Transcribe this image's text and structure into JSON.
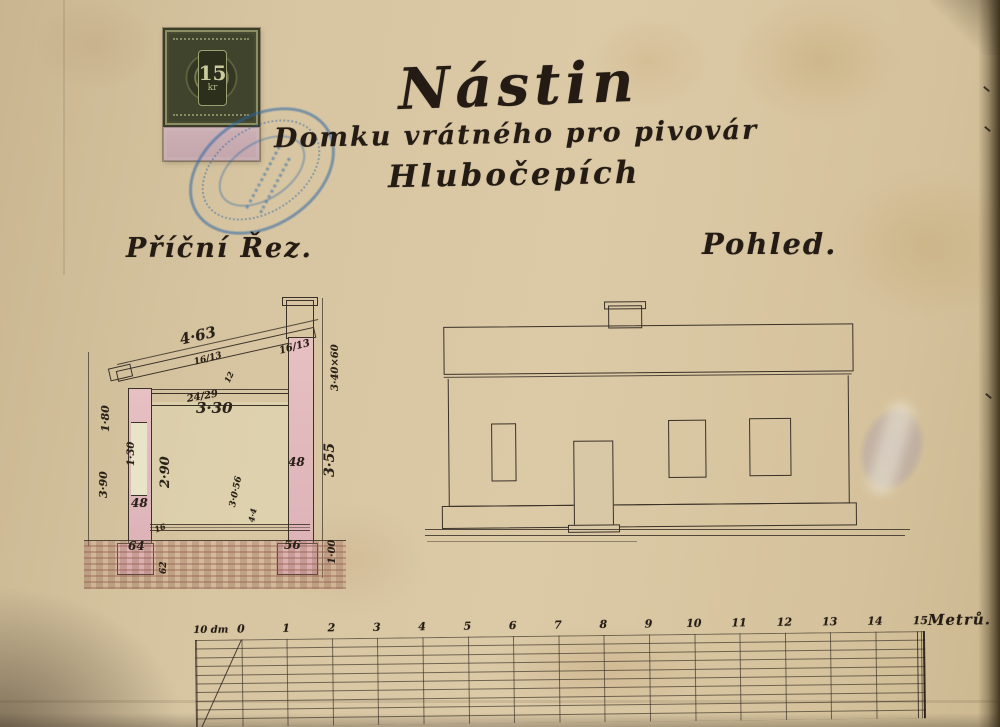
{
  "document": {
    "title_line1": "Nástin",
    "title_line2": "Domku vrátného pro pivovár",
    "title_line3": "Hlubočepích",
    "section_label": "Příční Řez.",
    "elevation_label": "Pohled."
  },
  "stamp": {
    "value": "15",
    "unit": "kr"
  },
  "seal": {
    "description": "blue-oval-official-stamp-illegible"
  },
  "section": {
    "dimensions": [
      {
        "text": "4·63",
        "x": 178,
        "y": 331,
        "rot": -13,
        "size": 15
      },
      {
        "text": "16/13",
        "x": 193,
        "y": 358,
        "rot": -15,
        "size": 9
      },
      {
        "text": "16/13",
        "x": 278,
        "y": 346,
        "rot": -15,
        "size": 10
      },
      {
        "text": "24/29",
        "x": 186,
        "y": 394,
        "rot": -10,
        "size": 10
      },
      {
        "text": "12",
        "x": 222,
        "y": 380,
        "rot": -65,
        "size": 8
      },
      {
        "text": "3·30",
        "x": 196,
        "y": 399,
        "rot": 0,
        "size": 15
      },
      {
        "text": "1·80",
        "x": 99,
        "y": 432,
        "rot": -90,
        "size": 11
      },
      {
        "text": "1·30",
        "x": 126,
        "y": 466,
        "rot": -90,
        "size": 10
      },
      {
        "text": "3·90",
        "x": 97,
        "y": 498,
        "rot": -90,
        "size": 11
      },
      {
        "text": "2·90",
        "x": 158,
        "y": 488,
        "rot": -90,
        "size": 13
      },
      {
        "text": "48",
        "x": 131,
        "y": 496,
        "rot": 0,
        "size": 12
      },
      {
        "text": "64",
        "x": 128,
        "y": 539,
        "rot": 0,
        "size": 12
      },
      {
        "text": "48",
        "x": 288,
        "y": 455,
        "rot": 0,
        "size": 12
      },
      {
        "text": "56",
        "x": 284,
        "y": 538,
        "rot": 0,
        "size": 12
      },
      {
        "text": "3·55",
        "x": 322,
        "y": 477,
        "rot": -90,
        "size": 14
      },
      {
        "text": "1·00",
        "x": 327,
        "y": 564,
        "rot": -90,
        "size": 10
      },
      {
        "text": "3·40×60",
        "x": 330,
        "y": 391,
        "rot": -90,
        "size": 10
      },
      {
        "text": "16",
        "x": 153,
        "y": 525,
        "rot": -20,
        "size": 8
      },
      {
        "text": "62",
        "x": 159,
        "y": 574,
        "rot": -90,
        "size": 9
      },
      {
        "text": "3·0·56",
        "x": 228,
        "y": 506,
        "rot": -78,
        "size": 9
      },
      {
        "text": "4·4",
        "x": 246,
        "y": 521,
        "rot": -78,
        "size": 8
      }
    ]
  },
  "scale_bar": {
    "left_label": "10 dm",
    "unit_label": "Metrů.",
    "numbers": [
      "0",
      "1",
      "2",
      "3",
      "4",
      "5",
      "6",
      "7",
      "8",
      "9",
      "10",
      "11",
      "12",
      "13",
      "14",
      "15"
    ]
  },
  "colors": {
    "paper": "#d7c5a1",
    "ink": "#241c14",
    "wall_pink": "#e2bcc0",
    "seal_blue": "#2f6fb0",
    "stamp_olive": "#474b31",
    "stamp_panel_pink": "#c9adb3",
    "smudge_purple": "#8d80b5"
  }
}
